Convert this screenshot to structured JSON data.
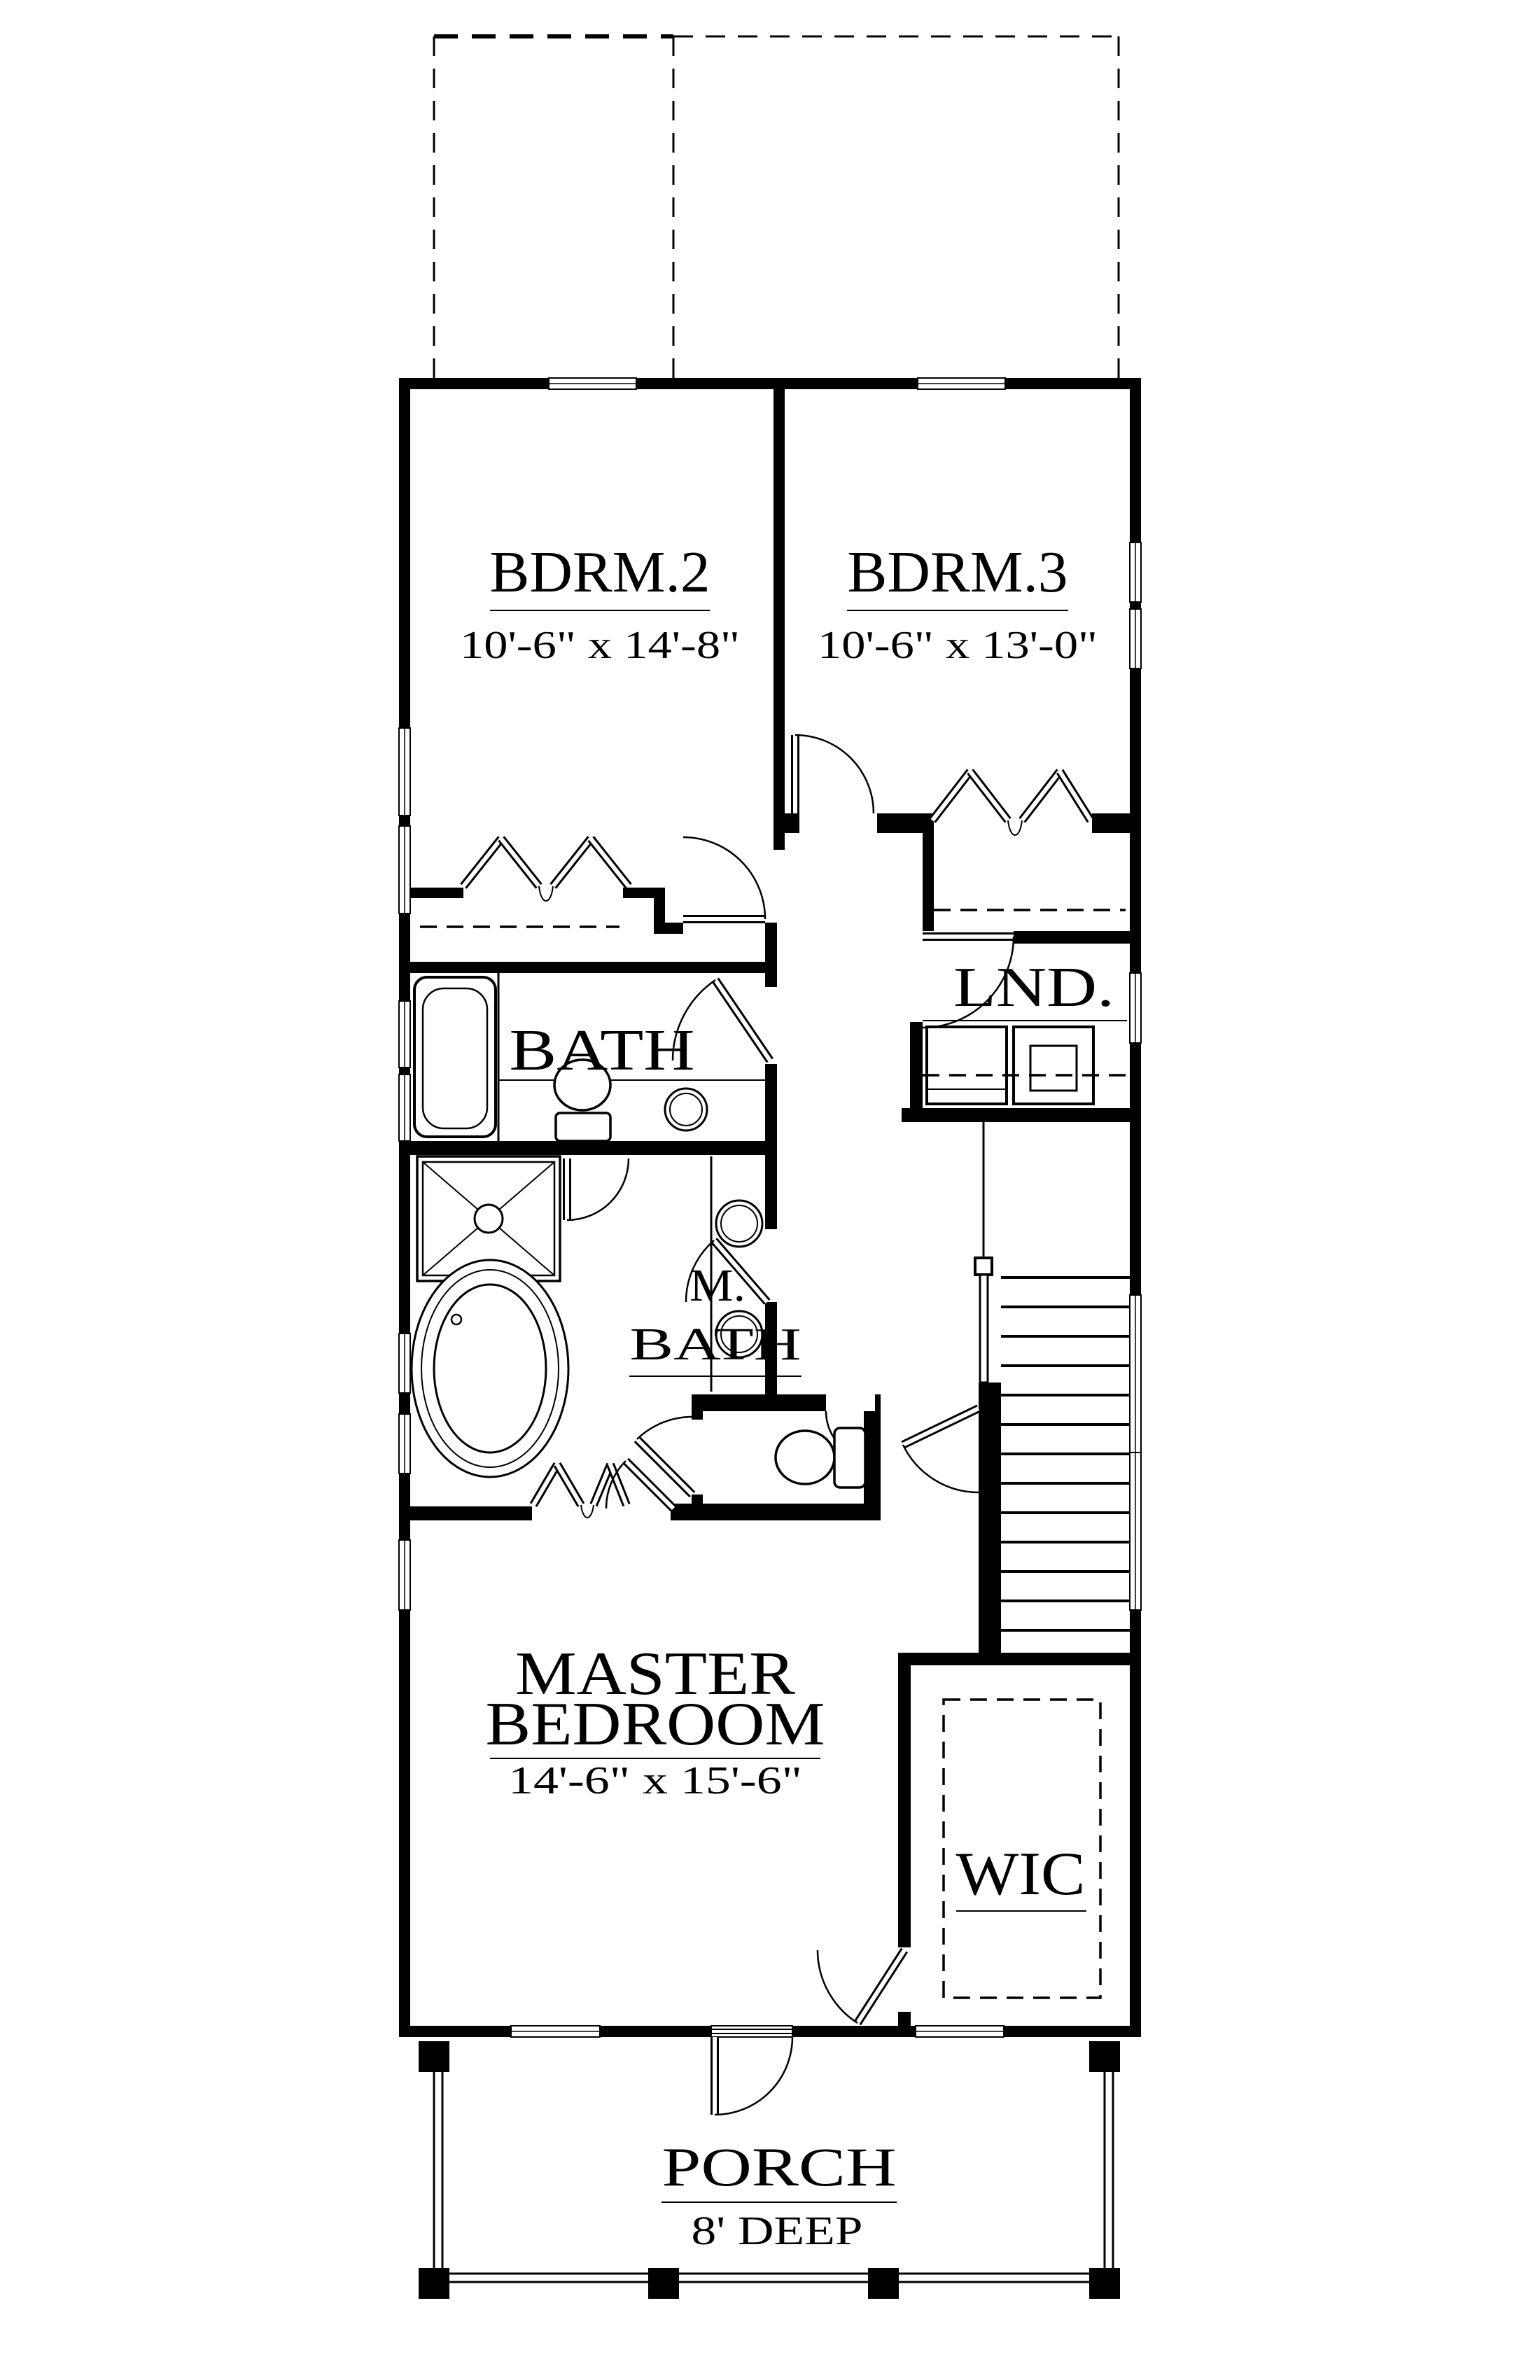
{
  "colors": {
    "ink": "#000000",
    "paper": "#ffffff"
  },
  "rooms": {
    "bdrm2": {
      "name": "BDRM.2",
      "dims": "10'-6\" x 14'-8\""
    },
    "bdrm3": {
      "name": "BDRM.3",
      "dims": "10'-6\" x 13'-0\""
    },
    "laundry": {
      "name": "LND."
    },
    "bath": {
      "name": "BATH"
    },
    "master_bath": {
      "line1": "M.",
      "line2": "BATH"
    },
    "master_bedroom": {
      "line1": "MASTER",
      "line2": "BEDROOM",
      "dims": "14'-6\" x 15'-6\""
    },
    "wic": {
      "name": "WIC"
    },
    "porch": {
      "name": "PORCH",
      "dims": "8' DEEP"
    }
  }
}
